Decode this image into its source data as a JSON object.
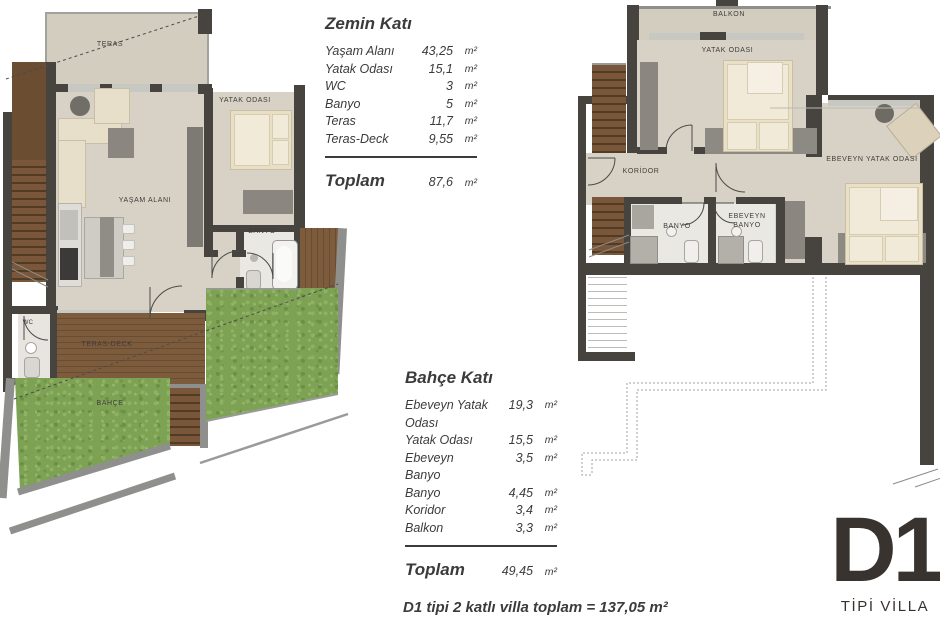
{
  "ground_floor": {
    "title": "Zemin Katı",
    "rows": [
      {
        "label": "Yaşam Alanı",
        "value": "43,25",
        "unit": "m²"
      },
      {
        "label": "Yatak Odası",
        "value": "15,1",
        "unit": "m²"
      },
      {
        "label": "WC",
        "value": "3",
        "unit": "m²"
      },
      {
        "label": "Banyo",
        "value": "5",
        "unit": "m²"
      },
      {
        "label": "Teras",
        "value": "11,7",
        "unit": "m²"
      },
      {
        "label": "Teras-Deck",
        "value": "9,55",
        "unit": "m²"
      }
    ],
    "total": {
      "label": "Toplam",
      "value": "87,6",
      "unit": "m²"
    },
    "plan_labels": {
      "teras": "TERAS",
      "yasam_alani": "YAŞAM ALANI",
      "yatak_odasi": "YATAK ODASI",
      "banyo": "BANYO",
      "wc": "WC",
      "teras_deck": "TERAS-DECK",
      "bahce": "BAHÇE"
    }
  },
  "garden_floor": {
    "title": "Bahçe Katı",
    "rows": [
      {
        "label": "Ebeveyn Yatak Odası",
        "value": "19,3",
        "unit": "m²"
      },
      {
        "label": "Yatak Odası",
        "value": "15,5",
        "unit": "m²"
      },
      {
        "label": "Ebeveyn Banyo",
        "value": "3,5",
        "unit": "m²"
      },
      {
        "label": "Banyo",
        "value": "4,45",
        "unit": "m²"
      },
      {
        "label": "Koridor",
        "value": "3,4",
        "unit": "m²"
      },
      {
        "label": "Balkon",
        "value": "3,3",
        "unit": "m²"
      }
    ],
    "total": {
      "label": "Toplam",
      "value": "49,45",
      "unit": "m²"
    },
    "plan_labels": {
      "balkon": "BALKON",
      "yatak_odasi": "YATAK ODASI",
      "ebeveyn_yatak_odasi": "EBEVEYN YATAK ODASI",
      "koridor": "KORİDOR",
      "banyo": "BANYO",
      "ebeveyn_banyo": "EBEVEYN BANYO"
    }
  },
  "summary_line": "D1 tipi 2 katlı villa toplam = 137,05 m²",
  "badge": {
    "code": "D1",
    "subtitle": "TİPİ VİLLA"
  },
  "colors": {
    "wall": "#47443f",
    "floor": "#d8d2c6",
    "grass": "#7da254",
    "wood": "#7d5c3e",
    "retaining_wall": "#8f8f8d",
    "text": "#3b3b3b",
    "badge_text": "#393330"
  }
}
